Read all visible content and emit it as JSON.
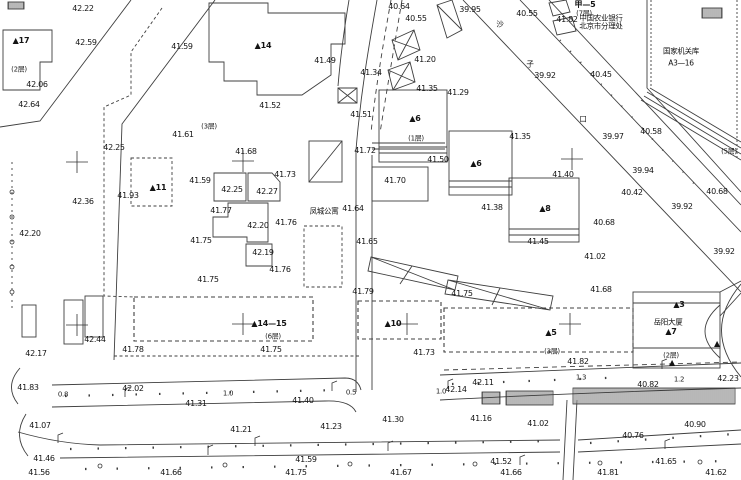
{
  "canvas": {
    "width": 741,
    "height": 480,
    "background": "#ffffff",
    "line_color": "#3f3f3f",
    "label_color": "#141414"
  },
  "elevation_labels": [
    {
      "t": "42.22",
      "x": 83,
      "y": 9
    },
    {
      "t": "42.59",
      "x": 86,
      "y": 43
    },
    {
      "t": "41.59",
      "x": 182,
      "y": 47
    },
    {
      "t": "42.06",
      "x": 37,
      "y": 85
    },
    {
      "t": "42.64",
      "x": 29,
      "y": 105
    },
    {
      "t": "41.61",
      "x": 183,
      "y": 135
    },
    {
      "t": "42.25",
      "x": 114,
      "y": 148
    },
    {
      "t": "40.64",
      "x": 399,
      "y": 7
    },
    {
      "t": "40.55",
      "x": 416,
      "y": 19
    },
    {
      "t": "39.95",
      "x": 470,
      "y": 10
    },
    {
      "t": "40.55",
      "x": 527,
      "y": 14
    },
    {
      "t": "41.82",
      "x": 567,
      "y": 20
    },
    {
      "t": "39.92",
      "x": 545,
      "y": 76
    },
    {
      "t": "40.45",
      "x": 601,
      "y": 75
    },
    {
      "t": "41.49",
      "x": 325,
      "y": 61
    },
    {
      "t": "41.20",
      "x": 425,
      "y": 60
    },
    {
      "t": "41.34",
      "x": 371,
      "y": 73
    },
    {
      "t": "41.29",
      "x": 458,
      "y": 93
    },
    {
      "t": "41.35",
      "x": 427,
      "y": 89
    },
    {
      "t": "41.52",
      "x": 270,
      "y": 106
    },
    {
      "t": "41.51",
      "x": 361,
      "y": 115
    },
    {
      "t": "41.72",
      "x": 365,
      "y": 151
    },
    {
      "t": "41.50",
      "x": 438,
      "y": 160
    },
    {
      "t": "41.35",
      "x": 520,
      "y": 137
    },
    {
      "t": "39.97",
      "x": 613,
      "y": 137
    },
    {
      "t": "40.58",
      "x": 651,
      "y": 132
    },
    {
      "t": "39.94",
      "x": 643,
      "y": 171
    },
    {
      "t": "40.42",
      "x": 632,
      "y": 193
    },
    {
      "t": "40.68",
      "x": 717,
      "y": 192
    },
    {
      "t": "39.92",
      "x": 682,
      "y": 207
    },
    {
      "t": "40.68",
      "x": 604,
      "y": 223
    },
    {
      "t": "39.92",
      "x": 724,
      "y": 252
    },
    {
      "t": "41.02",
      "x": 595,
      "y": 257
    },
    {
      "t": "41.68",
      "x": 601,
      "y": 290
    },
    {
      "t": "41.68",
      "x": 246,
      "y": 152
    },
    {
      "t": "41.73",
      "x": 285,
      "y": 175
    },
    {
      "t": "41.59",
      "x": 200,
      "y": 181
    },
    {
      "t": "42.25",
      "x": 232,
      "y": 190
    },
    {
      "t": "42.27",
      "x": 267,
      "y": 192
    },
    {
      "t": "41.77",
      "x": 221,
      "y": 211
    },
    {
      "t": "41.64",
      "x": 353,
      "y": 209
    },
    {
      "t": "42.20",
      "x": 258,
      "y": 226
    },
    {
      "t": "41.76",
      "x": 286,
      "y": 223
    },
    {
      "t": "41.75",
      "x": 201,
      "y": 241
    },
    {
      "t": "42.19",
      "x": 263,
      "y": 253
    },
    {
      "t": "41.65",
      "x": 367,
      "y": 242
    },
    {
      "t": "41.76",
      "x": 280,
      "y": 270
    },
    {
      "t": "41.75",
      "x": 208,
      "y": 280
    },
    {
      "t": "41.93",
      "x": 128,
      "y": 196
    },
    {
      "t": "42.36",
      "x": 83,
      "y": 202
    },
    {
      "t": "42.20",
      "x": 30,
      "y": 234
    },
    {
      "t": "41.70",
      "x": 395,
      "y": 181
    },
    {
      "t": "41.38",
      "x": 492,
      "y": 208
    },
    {
      "t": "41.40",
      "x": 563,
      "y": 175
    },
    {
      "t": "41.45",
      "x": 538,
      "y": 242
    },
    {
      "t": "41.79",
      "x": 363,
      "y": 292
    },
    {
      "t": "41.75",
      "x": 462,
      "y": 294
    },
    {
      "t": "42.44",
      "x": 95,
      "y": 340
    },
    {
      "t": "42.17",
      "x": 36,
      "y": 354
    },
    {
      "t": "41.78",
      "x": 133,
      "y": 350
    },
    {
      "t": "41.75",
      "x": 271,
      "y": 350
    },
    {
      "t": "41.73",
      "x": 424,
      "y": 353
    },
    {
      "t": "41.82",
      "x": 578,
      "y": 362
    },
    {
      "t": "41.83",
      "x": 28,
      "y": 388
    },
    {
      "t": "42.02",
      "x": 133,
      "y": 389
    },
    {
      "t": "41.31",
      "x": 196,
      "y": 404
    },
    {
      "t": "41.40",
      "x": 303,
      "y": 401
    },
    {
      "t": "42.14",
      "x": 456,
      "y": 390
    },
    {
      "t": "42.11",
      "x": 483,
      "y": 383
    },
    {
      "t": "40.82",
      "x": 648,
      "y": 385
    },
    {
      "t": "42.23",
      "x": 728,
      "y": 379
    },
    {
      "t": "41.07",
      "x": 40,
      "y": 426
    },
    {
      "t": "41.21",
      "x": 241,
      "y": 430
    },
    {
      "t": "41.23",
      "x": 331,
      "y": 427
    },
    {
      "t": "41.30",
      "x": 393,
      "y": 420
    },
    {
      "t": "41.16",
      "x": 481,
      "y": 419
    },
    {
      "t": "41.02",
      "x": 538,
      "y": 424
    },
    {
      "t": "40.76",
      "x": 633,
      "y": 436
    },
    {
      "t": "40.90",
      "x": 695,
      "y": 425
    },
    {
      "t": "41.46",
      "x": 44,
      "y": 459
    },
    {
      "t": "41.59",
      "x": 306,
      "y": 460
    },
    {
      "t": "41.52",
      "x": 501,
      "y": 462
    },
    {
      "t": "41.65",
      "x": 666,
      "y": 462
    },
    {
      "t": "41.56",
      "x": 39,
      "y": 473
    },
    {
      "t": "41.66",
      "x": 171,
      "y": 473
    },
    {
      "t": "41.75",
      "x": 296,
      "y": 473
    },
    {
      "t": "41.67",
      "x": 401,
      "y": 473
    },
    {
      "t": "41.66",
      "x": 511,
      "y": 473
    },
    {
      "t": "41.81",
      "x": 608,
      "y": 473
    },
    {
      "t": "41.62",
      "x": 716,
      "y": 473
    }
  ],
  "width_labels": [
    {
      "t": "0.8",
      "x": 63,
      "y": 395
    },
    {
      "t": "1.0",
      "x": 228,
      "y": 394
    },
    {
      "t": "0.5",
      "x": 351,
      "y": 393
    },
    {
      "t": "1.0",
      "x": 441,
      "y": 392
    },
    {
      "t": "1.3",
      "x": 581,
      "y": 378
    },
    {
      "t": "1.2",
      "x": 679,
      "y": 380
    }
  ],
  "building_labels": [
    {
      "t": "▲17",
      "x": 21,
      "y": 41
    },
    {
      "t": "▲14",
      "x": 263,
      "y": 46
    },
    {
      "t": "▲11",
      "x": 158,
      "y": 188
    },
    {
      "t": "▲6",
      "x": 415,
      "y": 119
    },
    {
      "t": "▲6",
      "x": 476,
      "y": 164
    },
    {
      "t": "▲8",
      "x": 545,
      "y": 209
    },
    {
      "t": "▲10",
      "x": 393,
      "y": 324
    },
    {
      "t": "▲14—15",
      "x": 269,
      "y": 324
    },
    {
      "t": "▲5",
      "x": 551,
      "y": 333
    },
    {
      "t": "▲7",
      "x": 671,
      "y": 332
    },
    {
      "t": "▲3",
      "x": 679,
      "y": 305
    },
    {
      "t": "甲—5",
      "x": 585,
      "y": 5
    },
    {
      "t": "▲",
      "x": 672,
      "y": 363
    },
    {
      "t": "▲",
      "x": 717,
      "y": 344
    }
  ],
  "floor_labels": [
    {
      "t": "(2层)",
      "x": 19,
      "y": 70
    },
    {
      "t": "(3层)",
      "x": 209,
      "y": 127
    },
    {
      "t": "(1层)",
      "x": 416,
      "y": 139
    },
    {
      "t": "(6层)",
      "x": 273,
      "y": 337
    },
    {
      "t": "(3层)",
      "x": 552,
      "y": 352
    },
    {
      "t": "(2层)",
      "x": 671,
      "y": 356
    },
    {
      "t": "(7层)",
      "x": 584,
      "y": 14
    },
    {
      "t": "(5层)",
      "x": 729,
      "y": 152
    }
  ],
  "name_labels": [
    {
      "t": "凤城公寓",
      "x": 324,
      "y": 211
    },
    {
      "t": "岳阳大厦",
      "x": 668,
      "y": 322
    },
    {
      "t": "中国农业银行",
      "x": 601,
      "y": 18
    },
    {
      "t": "北京市分理处",
      "x": 601,
      "y": 26
    },
    {
      "t": "国家机关库",
      "x": 681,
      "y": 51
    },
    {
      "t": "A3—16",
      "x": 681,
      "y": 63
    },
    {
      "t": "沙",
      "x": 500,
      "y": 24
    },
    {
      "t": "子",
      "x": 530,
      "y": 64
    },
    {
      "t": "口",
      "x": 583,
      "y": 119
    }
  ],
  "cross_marks": [
    {
      "x": 77,
      "y": 162
    },
    {
      "x": 243,
      "y": 161
    },
    {
      "x": 572,
      "y": 159
    },
    {
      "x": 77,
      "y": 325
    },
    {
      "x": 243,
      "y": 324
    },
    {
      "x": 407,
      "y": 324
    },
    {
      "x": 570,
      "y": 324
    }
  ],
  "map_symbols": {
    "lamp_posts": [
      {
        "x": 125,
        "y": 397
      },
      {
        "x": 332,
        "y": 391
      },
      {
        "x": 448,
        "y": 389
      },
      {
        "x": 662,
        "y": 369
      },
      {
        "x": 58,
        "y": 443
      },
      {
        "x": 208,
        "y": 455
      },
      {
        "x": 388,
        "y": 451
      },
      {
        "x": 665,
        "y": 449
      },
      {
        "x": 255,
        "y": 446
      },
      {
        "x": 520,
        "y": 465
      }
    ],
    "trees": [
      {
        "x": 12,
        "y": 192
      },
      {
        "x": 12,
        "y": 217
      },
      {
        "x": 12,
        "y": 242
      },
      {
        "x": 12,
        "y": 267
      },
      {
        "x": 12,
        "y": 292
      },
      {
        "x": 100,
        "y": 466
      },
      {
        "x": 225,
        "y": 465
      },
      {
        "x": 350,
        "y": 464
      },
      {
        "x": 475,
        "y": 464
      },
      {
        "x": 600,
        "y": 463
      },
      {
        "x": 700,
        "y": 462
      }
    ]
  }
}
